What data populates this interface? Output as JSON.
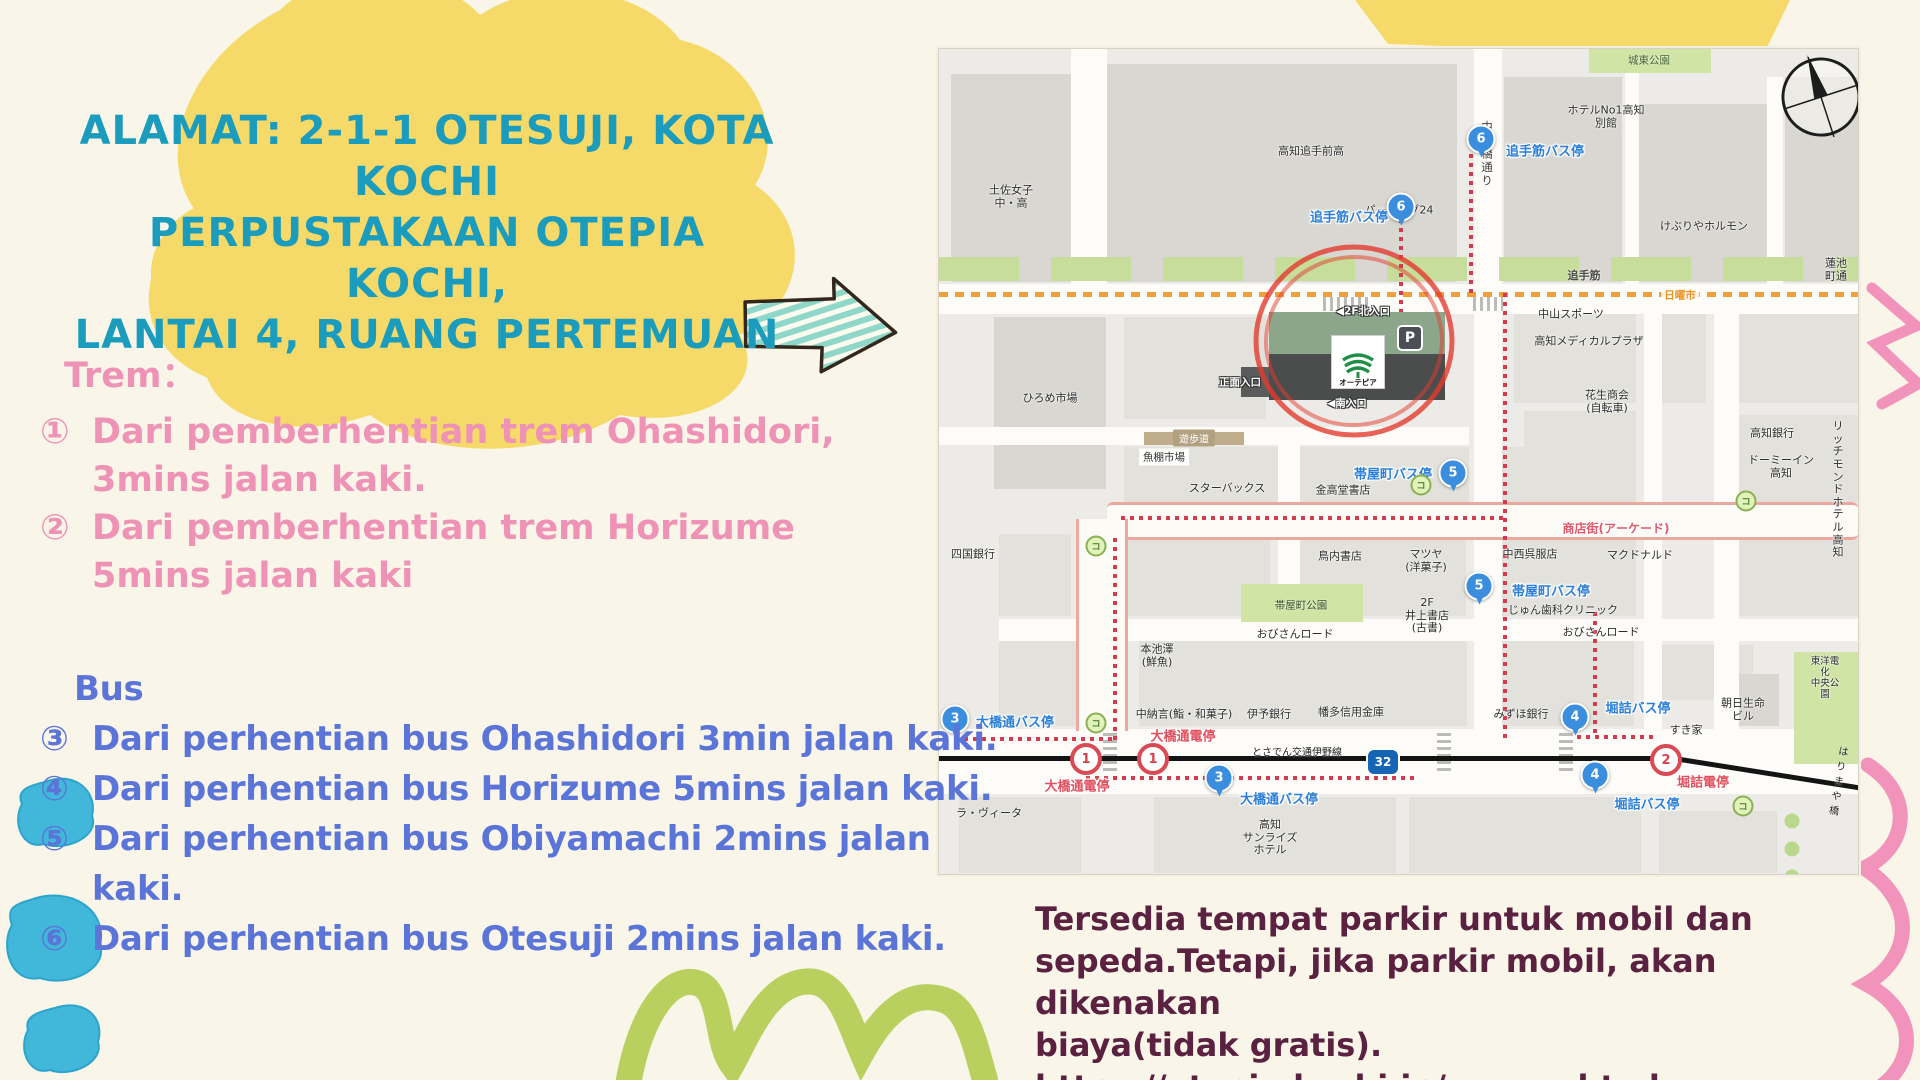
{
  "slide": {
    "title_lines": [
      "ALAMAT: 2-1-1 OTESUJI, KOTA",
      "KOCHI",
      "PERPUSTAKAAN OTEPIA KOCHI,",
      "LANTAI 4, RUANG PERTEMUAN"
    ],
    "tram": {
      "heading": "Trem：",
      "items": [
        {
          "num": "①",
          "line1": "Dari pemberhentian trem Ohashidori,",
          "line2": "3mins jalan kaki."
        },
        {
          "num": "②",
          "line1": "Dari pemberhentian trem Horizume",
          "line2": "5mins jalan kaki"
        }
      ]
    },
    "bus": {
      "heading": "Bus",
      "items": [
        {
          "num": "③",
          "text": "Dari perhentian bus Ohashidori 3min jalan kaki."
        },
        {
          "num": "④",
          "text": "Dari perhentian bus Horizume 5mins jalan kaki."
        },
        {
          "num": "⑤",
          "text": "Dari perhentian bus Obiyamachi 2mins jalan kaki."
        },
        {
          "num": "⑥",
          "text": "Dari perhentian bus Otesuji 2mins jalan kaki."
        }
      ]
    },
    "note_lines": [
      "Tersedia tempat parkir untuk mobil dan",
      "sepeda.Tetapi, jika parkir mobil, akan dikenakan",
      "biaya(tidak gratis).",
      "https://otepia.kochi.jp/access.html"
    ],
    "colors": {
      "title": "#1b9cbd",
      "tram": "#ee93b6",
      "bus": "#5a74d7",
      "note": "#5a2140",
      "yellow_blob": "#f6da69",
      "blue_scribble": "#41b7da",
      "green_scribble": "#b9d05e",
      "pink_scribble": "#f293bb",
      "mint_arrow": "#8fd7c9",
      "background": "#f9f5e9"
    }
  },
  "map": {
    "library": {
      "logo_text": "オーテピア",
      "parking_label": "P"
    },
    "rects": [
      {
        "x": 12,
        "y": 25,
        "w": 120,
        "h": 208,
        "c": "bk"
      },
      {
        "x": 168,
        "y": 15,
        "w": 350,
        "h": 218,
        "c": "bk"
      },
      {
        "x": 565,
        "y": 28,
        "w": 118,
        "h": 205,
        "c": "bk"
      },
      {
        "x": 700,
        "y": 55,
        "w": 128,
        "h": 178,
        "c": "bk"
      },
      {
        "x": 846,
        "y": 28,
        "w": 73,
        "h": 205,
        "c": "bk"
      },
      {
        "x": 55,
        "y": 268,
        "w": 112,
        "h": 172,
        "c": "bk"
      },
      {
        "x": 185,
        "y": 268,
        "w": 142,
        "h": 102,
        "c": "bk2"
      },
      {
        "x": 575,
        "y": 262,
        "w": 122,
        "h": 92,
        "c": "bk2"
      },
      {
        "x": 585,
        "y": 362,
        "w": 112,
        "h": 80,
        "c": "bk2"
      },
      {
        "x": 718,
        "y": 262,
        "w": 49,
        "h": 92,
        "c": "bk2"
      },
      {
        "x": 800,
        "y": 262,
        "w": 119,
        "h": 92,
        "c": "bk2"
      },
      {
        "x": 800,
        "y": 366,
        "w": 119,
        "h": 86,
        "c": "bk2"
      },
      {
        "x": 185,
        "y": 398,
        "w": 345,
        "h": 55,
        "c": "bk2"
      },
      {
        "x": 555,
        "y": 398,
        "w": 142,
        "h": 55,
        "c": "bk2"
      },
      {
        "x": 790,
        "y": 398,
        "w": 129,
        "h": 55,
        "c": "bk2"
      },
      {
        "x": 60,
        "y": 485,
        "w": 72,
        "h": 82,
        "c": "bk2"
      },
      {
        "x": 185,
        "y": 485,
        "w": 146,
        "h": 82,
        "c": "bk2"
      },
      {
        "x": 361,
        "y": 485,
        "w": 166,
        "h": 82,
        "c": "bk2"
      },
      {
        "x": 555,
        "y": 485,
        "w": 142,
        "h": 82,
        "c": "bk2"
      },
      {
        "x": 790,
        "y": 485,
        "w": 129,
        "h": 82,
        "c": "bk2"
      },
      {
        "x": 60,
        "y": 592,
        "w": 118,
        "h": 85,
        "c": "bk2"
      },
      {
        "x": 200,
        "y": 592,
        "w": 328,
        "h": 85,
        "c": "bk2"
      },
      {
        "x": 555,
        "y": 592,
        "w": 140,
        "h": 85,
        "c": "bk2"
      },
      {
        "x": 718,
        "y": 596,
        "w": 96,
        "h": 55,
        "c": "bk2"
      },
      {
        "x": 782,
        "y": 625,
        "w": 58,
        "h": 52,
        "c": "bk"
      },
      {
        "x": 20,
        "y": 748,
        "w": 122,
        "h": 76,
        "c": "bk2"
      },
      {
        "x": 215,
        "y": 748,
        "w": 242,
        "h": 76,
        "c": "bk2"
      },
      {
        "x": 470,
        "y": 748,
        "w": 232,
        "h": 76,
        "c": "bk2"
      },
      {
        "x": 720,
        "y": 762,
        "w": 118,
        "h": 62,
        "c": "bk2"
      },
      {
        "x": 132,
        "y": 0,
        "w": 36,
        "h": 235,
        "c": "st"
      },
      {
        "x": 535,
        "y": 0,
        "w": 28,
        "h": 235,
        "c": "st"
      },
      {
        "x": 686,
        "y": 0,
        "w": 14,
        "h": 235,
        "c": "st"
      },
      {
        "x": 828,
        "y": 28,
        "w": 16,
        "h": 207,
        "c": "st"
      },
      {
        "x": 0,
        "y": 235,
        "w": 919,
        "h": 30,
        "c": "st"
      },
      {
        "x": 0,
        "y": 378,
        "w": 530,
        "h": 18,
        "c": "st"
      },
      {
        "x": 60,
        "y": 570,
        "w": 859,
        "h": 22,
        "c": "st"
      },
      {
        "x": 0,
        "y": 680,
        "w": 919,
        "h": 65,
        "c": "st"
      },
      {
        "x": 535,
        "y": 265,
        "w": 28,
        "h": 415,
        "c": "st"
      },
      {
        "x": 775,
        "y": 262,
        "w": 25,
        "h": 418,
        "c": "st"
      },
      {
        "x": 705,
        "y": 262,
        "w": 18,
        "h": 418,
        "c": "st"
      },
      {
        "x": 339,
        "y": 378,
        "w": 22,
        "h": 192,
        "c": "st"
      },
      {
        "x": 168,
        "y": 453,
        "w": 751,
        "h": 32,
        "c": "bh"
      },
      {
        "x": 137,
        "y": 470,
        "w": 46,
        "h": 212,
        "c": "bv"
      },
      {
        "x": 205,
        "y": 383,
        "w": 100,
        "h": 13,
        "c": "tn"
      },
      {
        "x": 650,
        "y": 0,
        "w": 122,
        "h": 24,
        "c": "gpark"
      },
      {
        "x": 302,
        "y": 535,
        "w": 122,
        "h": 38,
        "c": "gpark"
      },
      {
        "x": 855,
        "y": 603,
        "w": 64,
        "h": 112,
        "c": "gpark"
      },
      {
        "x": 384,
        "y": 248,
        "w": 46,
        "h": 14,
        "c": "cwh"
      },
      {
        "x": 534,
        "y": 248,
        "w": 30,
        "h": 14,
        "c": "cwh"
      },
      {
        "x": 164,
        "y": 684,
        "w": 14,
        "h": 38,
        "c": "cwv"
      },
      {
        "x": 498,
        "y": 684,
        "w": 14,
        "h": 38,
        "c": "cwv"
      },
      {
        "x": 620,
        "y": 684,
        "w": 14,
        "h": 38,
        "c": "cwv"
      },
      {
        "x": 530,
        "y": 104,
        "w": 4,
        "h": 140,
        "c": "rtv"
      },
      {
        "x": 460,
        "y": 168,
        "w": 4,
        "h": 96,
        "c": "rtv"
      },
      {
        "x": 564,
        "y": 242,
        "w": 4,
        "h": 447,
        "c": "rtv"
      },
      {
        "x": 182,
        "y": 467,
        "w": 384,
        "h": 4,
        "c": "rth"
      },
      {
        "x": 174,
        "y": 485,
        "w": 4,
        "h": 206,
        "c": "rtv"
      },
      {
        "x": 16,
        "y": 688,
        "w": 162,
        "h": 4,
        "c": "rth"
      },
      {
        "x": 147,
        "y": 727,
        "w": 332,
        "h": 4,
        "c": "rth"
      },
      {
        "x": 654,
        "y": 562,
        "w": 4,
        "h": 122,
        "c": "rtv"
      },
      {
        "x": 638,
        "y": 686,
        "w": 80,
        "h": 4,
        "c": "rth"
      },
      {
        "x": 0,
        "y": 707,
        "w": 737,
        "h": 5,
        "c": "rail"
      },
      {
        "x": 735,
        "y": 707,
        "w": 192,
        "h": 5,
        "c": "rail r9"
      }
    ],
    "labels": [
      {
        "t": "土佐女子\n中・高",
        "x": 72,
        "y": 148,
        "c": "pl"
      },
      {
        "t": "高知追手前高",
        "x": 372,
        "y": 103,
        "c": "pl"
      },
      {
        "t": "ホテルNo1高知\n別館",
        "x": 667,
        "y": 68,
        "c": "pl"
      },
      {
        "t": "けぶりやホルモン",
        "x": 765,
        "y": 178,
        "c": "pl"
      },
      {
        "t": "パーキング24",
        "x": 460,
        "y": 162,
        "c": "pl"
      },
      {
        "t": "蓮池町通",
        "x": 897,
        "y": 221,
        "c": "pl"
      },
      {
        "t": "中山スポーツ",
        "x": 632,
        "y": 266,
        "c": "pl"
      },
      {
        "t": "高知メディカルプラザ",
        "x": 650,
        "y": 293,
        "c": "pl"
      },
      {
        "t": "花生商会\n(自転車)",
        "x": 668,
        "y": 353,
        "c": "pl"
      },
      {
        "t": "高知銀行",
        "x": 833,
        "y": 385,
        "c": "pl"
      },
      {
        "t": "ドーミーイン\n高知",
        "x": 842,
        "y": 418,
        "c": "pl"
      },
      {
        "t": "リッチモンド\nホテル高知",
        "x": 899,
        "y": 441,
        "c": "pl"
      },
      {
        "t": "ひろめ市場",
        "x": 111,
        "y": 350,
        "c": "pl"
      },
      {
        "t": "スターバックス",
        "x": 288,
        "y": 440,
        "c": "pl"
      },
      {
        "t": "金高堂書店",
        "x": 404,
        "y": 442,
        "c": "pl"
      },
      {
        "t": "鳥内書店",
        "x": 401,
        "y": 508,
        "c": "pl"
      },
      {
        "t": "マツヤ\n(洋菓子)",
        "x": 487,
        "y": 512,
        "c": "pl"
      },
      {
        "t": "中西呉服店",
        "x": 591,
        "y": 506,
        "c": "pl"
      },
      {
        "t": "マクドナルド",
        "x": 701,
        "y": 507,
        "c": "pl"
      },
      {
        "t": "2F\n井上書店\n(古書)",
        "x": 488,
        "y": 567,
        "c": "pl"
      },
      {
        "t": "じゅん歯科クリニック",
        "x": 624,
        "y": 562,
        "c": "pl"
      },
      {
        "t": "おびさんロード",
        "x": 356,
        "y": 586,
        "c": "pl"
      },
      {
        "t": "おびさんロード",
        "x": 662,
        "y": 584,
        "c": "pl"
      },
      {
        "t": "本池澤\n(鮮魚)",
        "x": 218,
        "y": 607,
        "c": "pl"
      },
      {
        "t": "四国銀行",
        "x": 34,
        "y": 506,
        "c": "pl"
      },
      {
        "t": "東洋電化\n中央公園",
        "x": 886,
        "y": 630,
        "c": "pl s"
      },
      {
        "t": "朝日生命\nビル",
        "x": 804,
        "y": 661,
        "c": "pl"
      },
      {
        "t": "すき家",
        "x": 747,
        "y": 682,
        "c": "pl"
      },
      {
        "t": "みずほ銀行",
        "x": 582,
        "y": 666,
        "c": "pl"
      },
      {
        "t": "幡多信用金庫",
        "x": 412,
        "y": 664,
        "c": "pl"
      },
      {
        "t": "伊予銀行",
        "x": 330,
        "y": 666,
        "c": "pl"
      },
      {
        "t": "中納言(鮨・和菓子)",
        "x": 245,
        "y": 666,
        "c": "pl"
      },
      {
        "t": "ラ・ヴィータ",
        "x": 50,
        "y": 765,
        "c": "pl"
      },
      {
        "t": "高知\nサンライズ\nホテル",
        "x": 331,
        "y": 789,
        "c": "pl"
      },
      {
        "t": "追手筋",
        "x": 645,
        "y": 226,
        "c": "sn"
      },
      {
        "t": "とさでん交通伊野線",
        "x": 358,
        "y": 702,
        "c": "sn k"
      },
      {
        "t": "はりまや橋",
        "x": 900,
        "y": 731,
        "c": "sn k",
        "r": 9
      },
      {
        "t": "中の橋通り",
        "x": 548,
        "y": 105,
        "c": "vt"
      },
      {
        "t": "城東公園",
        "x": 710,
        "y": 11,
        "c": "gl"
      },
      {
        "t": "帯屋町公園",
        "x": 362,
        "y": 556,
        "c": "gl d"
      },
      {
        "t": "日曜市",
        "x": 741,
        "y": 246,
        "c": "or"
      },
      {
        "t": "遊歩道",
        "x": 255,
        "y": 389,
        "c": "tt"
      },
      {
        "t": "魚棚市場",
        "x": 225,
        "y": 408,
        "c": "wt"
      },
      {
        "t": "商店街(アーケード)",
        "x": 677,
        "y": 479,
        "c": "pk"
      },
      {
        "t": "追手筋バス停",
        "x": 606,
        "y": 101,
        "c": "bl"
      },
      {
        "t": "追手筋バス停",
        "x": 410,
        "y": 167,
        "c": "bl"
      },
      {
        "t": "帯屋町バス停",
        "x": 454,
        "y": 424,
        "c": "bl"
      },
      {
        "t": "帯屋町バス停",
        "x": 612,
        "y": 541,
        "c": "bl"
      },
      {
        "t": "大橋通バス停",
        "x": 76,
        "y": 672,
        "c": "bl"
      },
      {
        "t": "大橋通バス停",
        "x": 340,
        "y": 749,
        "c": "bl"
      },
      {
        "t": "堀詰バス停",
        "x": 699,
        "y": 658,
        "c": "bl"
      },
      {
        "t": "堀詰バス停",
        "x": 708,
        "y": 754,
        "c": "bl"
      },
      {
        "t": "大橋通電停",
        "x": 244,
        "y": 686,
        "c": "rd"
      },
      {
        "t": "大橋通電停",
        "x": 138,
        "y": 736,
        "c": "rd"
      },
      {
        "t": "堀詰電停",
        "x": 764,
        "y": 732,
        "c": "rd"
      },
      {
        "t": "◀2F北入口",
        "x": 424,
        "y": 262,
        "c": "en"
      },
      {
        "t": "正面入口",
        "x": 301,
        "y": 333,
        "c": "en"
      },
      {
        "t": "◀南入口",
        "x": 408,
        "y": 354,
        "c": "en"
      }
    ],
    "bus_stops": [
      {
        "n": "6",
        "x": 542,
        "y": 90
      },
      {
        "n": "6",
        "x": 462,
        "y": 158
      },
      {
        "n": "5",
        "x": 514,
        "y": 424
      },
      {
        "n": "5",
        "x": 540,
        "y": 537
      },
      {
        "n": "4",
        "x": 636,
        "y": 668
      },
      {
        "n": "4",
        "x": 656,
        "y": 726
      },
      {
        "n": "3",
        "x": 16,
        "y": 670
      },
      {
        "n": "3",
        "x": 280,
        "y": 729
      }
    ],
    "tram_stops": [
      {
        "n": "1",
        "x": 147,
        "y": 710
      },
      {
        "n": "1",
        "x": 214,
        "y": 710
      },
      {
        "n": "2",
        "x": 727,
        "y": 711
      }
    ],
    "route_shield": {
      "label": "32",
      "x": 444,
      "y": 713
    },
    "conv_icons": [
      [
        482,
        436
      ],
      [
        157,
        674
      ],
      [
        804,
        757
      ],
      [
        157,
        497
      ],
      [
        807,
        452
      ]
    ],
    "trees": [
      [
        853,
        772
      ],
      [
        853,
        800
      ],
      [
        853,
        828
      ]
    ]
  }
}
